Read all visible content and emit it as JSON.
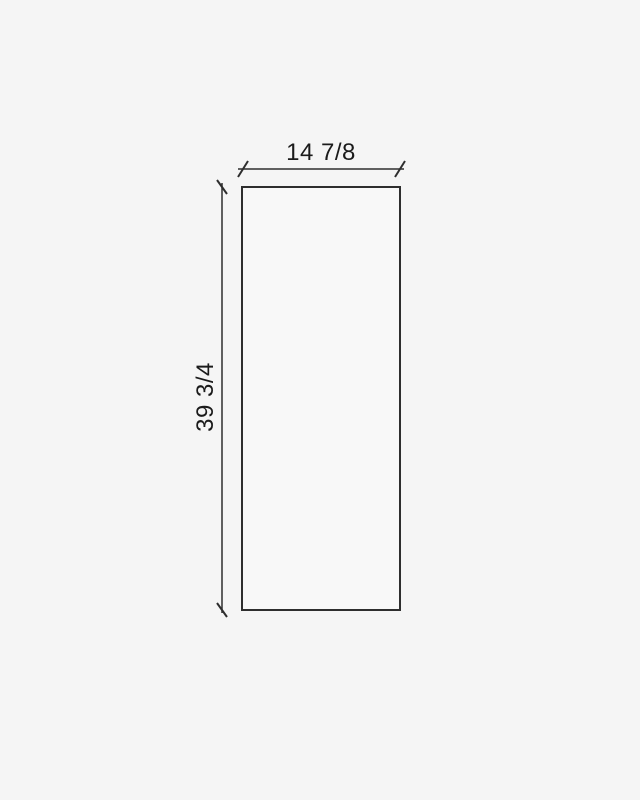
{
  "canvas": {
    "colors": {
      "background": "#f5f5f5",
      "panel-fill": "#f8f8f8",
      "line": "#2e2e2e",
      "text": "#1b1b1b"
    }
  },
  "drawing": {
    "type": "dimensioned-rectangle-elevation",
    "width_label": "14 7/8",
    "height_label": "39 3/4",
    "width_value": 14.875,
    "height_value": 39.75
  }
}
